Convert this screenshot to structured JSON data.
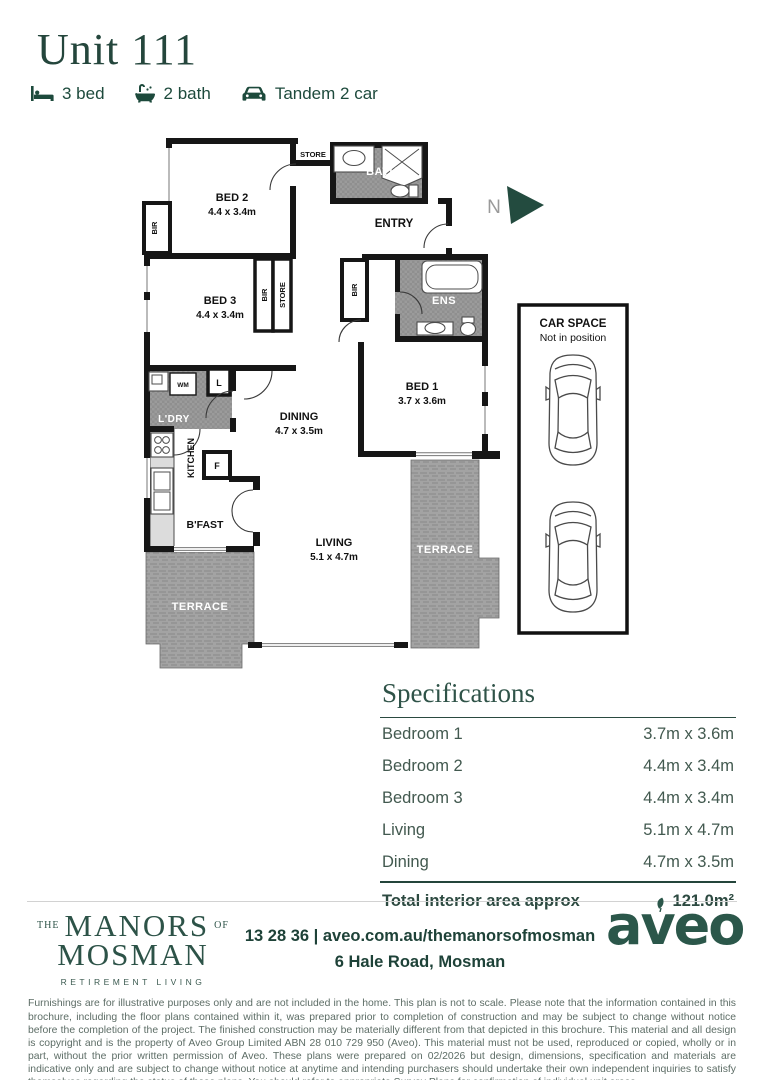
{
  "header": {
    "title": "Unit 111",
    "features": [
      {
        "icon": "bed-icon",
        "label": "3 bed"
      },
      {
        "icon": "bath-icon",
        "label": "2 bath"
      },
      {
        "icon": "car-icon",
        "label": "Tandem 2 car"
      }
    ]
  },
  "floor_plan": {
    "north": "N",
    "bed2_name": "BED 2",
    "bed2_dims": "4.4 x 3.4m",
    "bed3_name": "BED 3",
    "bed3_dims": "4.4 x 3.4m",
    "bed1_name": "BED 1",
    "bed1_dims": "3.7 x 3.6m",
    "dining_name": "DINING",
    "dining_dims": "4.7 x 3.5m",
    "living_name": "LIVING",
    "living_dims": "5.1 x 4.7m",
    "bath": "BATH",
    "ens": "ENS",
    "entry": "ENTRY",
    "store": "STORE",
    "bir": "BIR",
    "ldry": "L'DRY",
    "wm": "WM",
    "linen": "L",
    "kitchen": "KITCHEN",
    "fridge": "F",
    "bfast": "B'FAST",
    "terrace": "TERRACE",
    "car_space": {
      "title": "CAR SPACE",
      "subtitle": "Not in position"
    }
  },
  "specifications": {
    "heading": "Specifications",
    "rows": [
      {
        "label": "Bedroom 1",
        "value": "3.7m x 3.6m"
      },
      {
        "label": "Bedroom 2",
        "value": "4.4m x 3.4m"
      },
      {
        "label": "Bedroom 3",
        "value": "4.4m x 3.4m"
      },
      {
        "label": "Living",
        "value": "5.1m x 4.7m"
      },
      {
        "label": "Dining",
        "value": "4.7m x 3.5m"
      }
    ],
    "total_label": "Total interior area approx",
    "total_value": "121.0m²"
  },
  "footer": {
    "brand": {
      "the": "THE",
      "manors": "MANORS",
      "of": "OF",
      "mosman": "MOSMAN",
      "tagline": "RETIREMENT LIVING"
    },
    "contact_line1": "13 28 36 | aveo.com.au/themanorsofmosman",
    "contact_line2": "6 Hale Road, Mosman",
    "logo_text": "aveo"
  },
  "legal_text": "Furnishings are for illustrative purposes only and are not included in the home. This plan is not to scale. Please note that the information contained in this brochure, including the floor plans contained within it, was prepared prior to completion of construction and may be subject to change without notice before the completion of the project. The finished construction may be materially different from that depicted in this brochure. This material and all design is copyright and is the property of Aveo Group Limited ABN 28 010 729 950 (Aveo). This material must not be used, reproduced or copied, wholly or in part, without the prior written permission of Aveo. These plans were prepared on 02/2026 but design, dimensions, specification and materials are indicative only and are subject to change without notice at anytime and intending purchasers should undertake their own independent inquiries to satisfy themselves regarding the status of these plans. You should refer to appropriate Survey Plans for confirmation of individual unit areas."
}
